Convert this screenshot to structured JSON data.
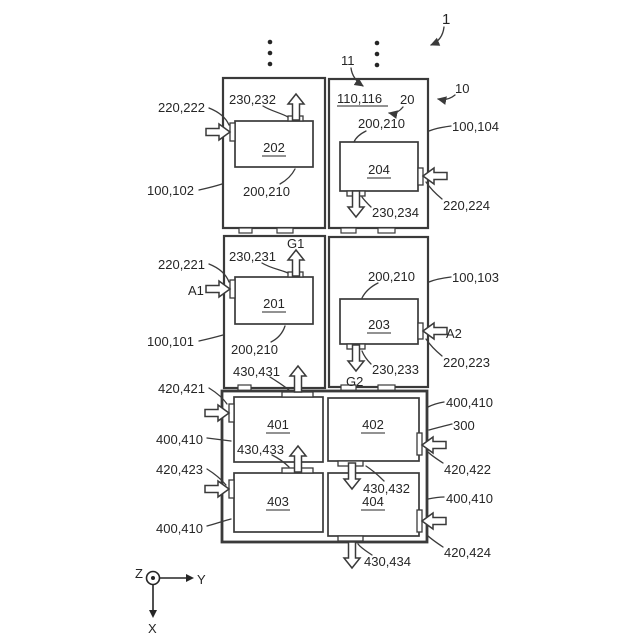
{
  "colors": {
    "line": "#3a3a3a",
    "text": "#262626",
    "background": "#ffffff"
  },
  "refs": {
    "assembly": "1",
    "stack": "11",
    "module": "10",
    "cells": "110,116",
    "spacer": "20"
  },
  "modules": {
    "top_left": {
      "housing": "100,102",
      "cell": "202",
      "cell_ref": "200,210",
      "inlet": "220,222",
      "outlet": "230,232"
    },
    "top_right": {
      "housing": "100,104",
      "cell": "204",
      "cell_ref": "200,210",
      "inlet": "220,224",
      "outlet": "230,234"
    },
    "mid_left": {
      "housing": "100,101",
      "cell": "201",
      "cell_ref": "200,210",
      "inlet": "220,221",
      "outlet": "230,231",
      "gas_in": "A1",
      "gas_out": "G1"
    },
    "mid_right": {
      "housing": "100,103",
      "cell": "203",
      "cell_ref": "200,210",
      "inlet": "220,223",
      "outlet": "230,233",
      "gas_in": "A2",
      "gas_out": "G2"
    }
  },
  "cooling": {
    "housing": "300",
    "unit_ref": "400,410",
    "units": {
      "u1": "401",
      "u2": "402",
      "u3": "403",
      "u4": "404"
    },
    "inlets": {
      "i1": "420,421",
      "i2": "420,422",
      "i3": "420,423",
      "i4": "420,424"
    },
    "outlets": {
      "o1": "430,431",
      "o2": "430,432",
      "o3": "430,433",
      "o4": "430,434"
    }
  },
  "axes": {
    "z": "Z",
    "y": "Y",
    "x": "X"
  }
}
